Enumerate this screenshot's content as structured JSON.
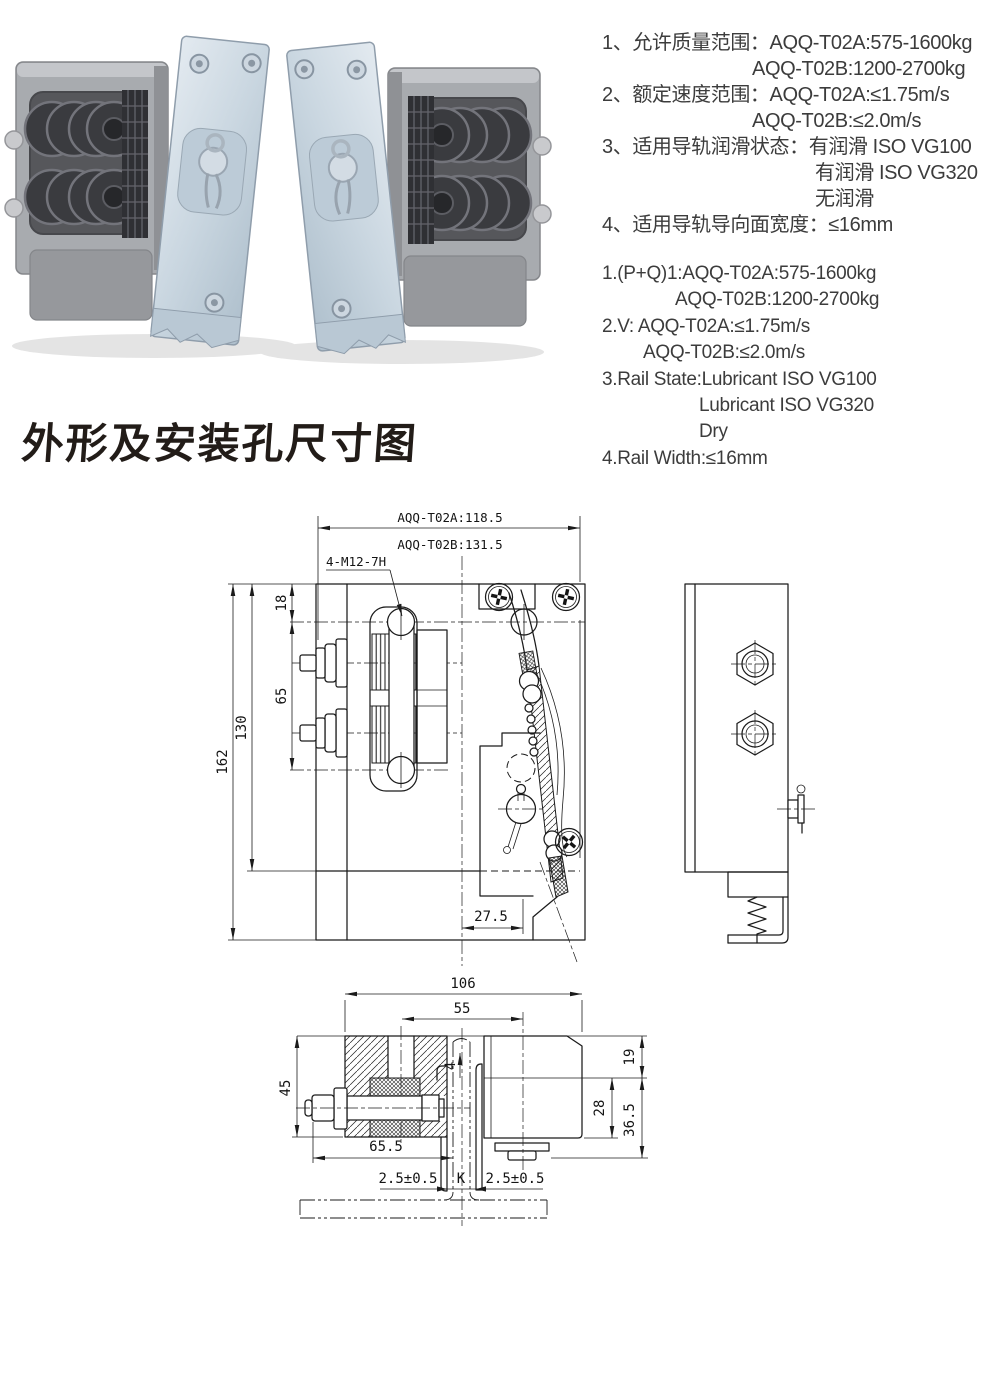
{
  "specs_cn": {
    "lines": [
      "1、允许质量范围：AQQ-T02A:575-1600kg",
      "AQQ-T02B:1200-2700kg",
      "2、额定速度范围：AQQ-T02A:≤1.75m/s",
      "AQQ-T02B:≤2.0m/s",
      "3、适用导轨润滑状态：有润滑 ISO VG100",
      "有润滑 ISO VG320",
      "无润滑",
      "4、适用导轨导向面宽度：≤16mm"
    ]
  },
  "specs_en": {
    "lines": [
      "1.(P+Q)1:AQQ-T02A:575-1600kg",
      "AQQ-T02B:1200-2700kg",
      "2.V: AQQ-T02A:≤1.75m/s",
      "AQQ-T02B:≤2.0m/s",
      "3.Rail State:Lubricant ISO VG100",
      "Lubricant ISO VG320",
      "Dry",
      "4.Rail Width:≤16mm"
    ]
  },
  "drawing_title": "外形及安装孔尺寸图",
  "front_view": {
    "width_a": "AQQ-T02A:118.5",
    "width_b": "AQQ-T02B:131.5",
    "thread_label": "4-M12-7H",
    "height_total": "162",
    "height_plate": "130",
    "hole_top_offset": "18",
    "hole_spacing": "65",
    "wedge_offset": "27.5"
  },
  "section_view": {
    "width_total": "106",
    "screw_offset": "55",
    "block_height": "45",
    "bolt_length": "65.5",
    "gap_left": "2.5±0.5",
    "rail_width": "K",
    "gap_right": "2.5±0.5",
    "lining_gap": "4",
    "step_depth": "19",
    "lower_height": "28",
    "bracket_height": "36.5"
  }
}
